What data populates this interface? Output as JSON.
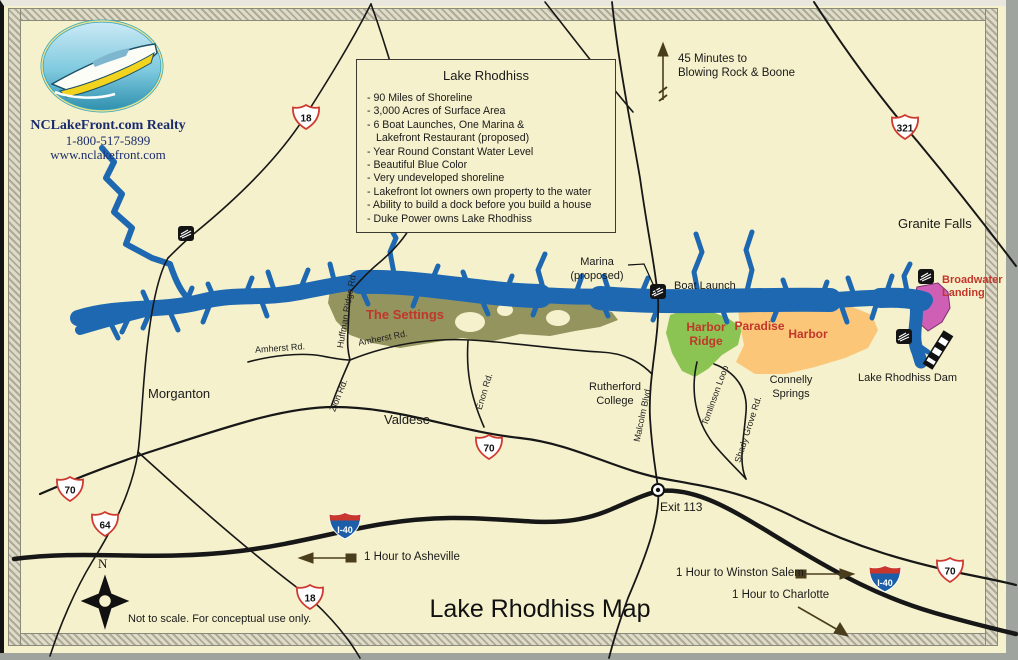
{
  "brand": {
    "name": "NCLakeFront.com Realty",
    "phone": "1-800-517-5899",
    "website": "www.nclakefront.com"
  },
  "info_box": {
    "title": "Lake Rhodhiss",
    "items": [
      "- 90 Miles of Shoreline",
      "- 3,000 Acres of Surface Area",
      "- 6 Boat Launches, One Marina &",
      "Lakefront Restaurant (proposed)",
      "- Year Round Constant Water Level",
      "- Beautiful Blue Color",
      "- Very undeveloped shoreline",
      "- Lakefront lot owners own property to the water",
      "- Ability to build a dock before you build a house",
      "- Duke Power owns Lake Rhodhiss"
    ]
  },
  "map_title": "Lake Rhodhiss Map",
  "disclaimer": "Not to scale.  For conceptual use only.",
  "compass": {
    "north": "N"
  },
  "towns": {
    "morganton": "Morganton",
    "valdese": "Valdese",
    "granite_falls": "Granite Falls",
    "rutherford_college": "Rutherford\nCollege",
    "connelly_springs": "Connelly\nSprings"
  },
  "developments": {
    "the_settings": "The Settings",
    "harbor_ridge": "Harbor\nRidge",
    "paradise_word": "Paradise",
    "harbor_word": "Harbor",
    "broadwater_landing": "Broadwater\nLanding"
  },
  "roads": {
    "huffman_ridge": "Huffman Ridge Rd",
    "amherst_west": "Amherst Rd.",
    "amherst_east": "Amherst Rd.",
    "zion": "Zion Rd.",
    "enon": "Enon Rd.",
    "malcolm": "Malcolm Blvd",
    "tomlinson": "Tomlinson Loop",
    "shady_grove": "Shady Grove Rd."
  },
  "shields": {
    "nc18_north": "18",
    "nc18_south": "18",
    "us321": "321",
    "us70_west": "70",
    "us70_mid": "70",
    "us70_east": "70",
    "us64": "64",
    "i40_west": "I-40",
    "i40_east": "I-40"
  },
  "poi": {
    "marina": "Marina\n(proposed)",
    "boat_launch": "Boat Launch",
    "dam": "Lake Rhodhiss Dam",
    "exit": "Exit 113"
  },
  "arrows": {
    "blowing_rock": "45 Minutes to\nBlowing Rock & Boone",
    "asheville": "1 Hour to Asheville",
    "winston_salem": "1 Hour to Winston Salem",
    "charlotte": "1 Hour to Charlotte"
  },
  "colors": {
    "background": "#f5f1cc",
    "lake": "#1e68b2",
    "road": "#171717",
    "settings_region": "#94945f",
    "harbor_ridge_region": "#8cc454",
    "paradise_region": "#fbc678",
    "broadwater_region": "#cf5fb5",
    "development_label": "#c1372a",
    "shield_outline": "#cf3a30",
    "interstate_blue": "#1c5fa8",
    "interstate_red": "#c8362e",
    "brand_navy": "#1b2c6e"
  }
}
